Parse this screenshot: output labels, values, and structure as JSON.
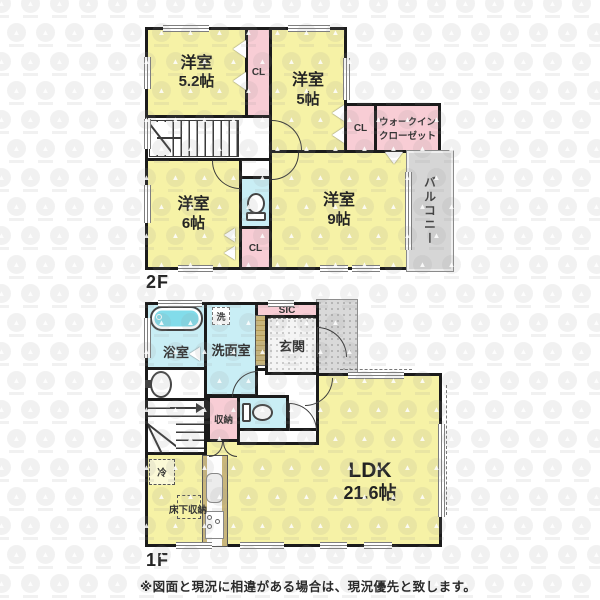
{
  "colors": {
    "wall": "#1b1b1b",
    "yellow": "#f6f2a6",
    "pink": "#f8cdd5",
    "cyan": "#c9eef5",
    "tub": "#82dcea",
    "balcony": "#d6d6d6",
    "tan": "#c9b67b"
  },
  "floor2": {
    "label": "2F",
    "room52": {
      "name": "洋室",
      "size": "5.2帖"
    },
    "room5": {
      "name": "洋室",
      "size": "5帖"
    },
    "room6": {
      "name": "洋室",
      "size": "6帖"
    },
    "room9": {
      "name": "洋室",
      "size": "9帖"
    },
    "cl_top": "CL",
    "cl_right": "CL",
    "cl_mid": "CL",
    "wic": {
      "line1": "ウォークイン",
      "line2": "クローゼット"
    },
    "balcony": "バルコニー"
  },
  "floor1": {
    "label": "1F",
    "bath": "浴室",
    "washer": "洗",
    "senmen": "洗面室",
    "sic": "SIC",
    "genkan": "玄関",
    "storage": "収納",
    "fridge": "冷",
    "underfloor": "床下収納",
    "ldk": {
      "name": "LDK",
      "size": "21.6帖"
    }
  },
  "footer": {
    "disclaimer": "※図面と現況に相違がある場合は、現況優先と致します。"
  }
}
